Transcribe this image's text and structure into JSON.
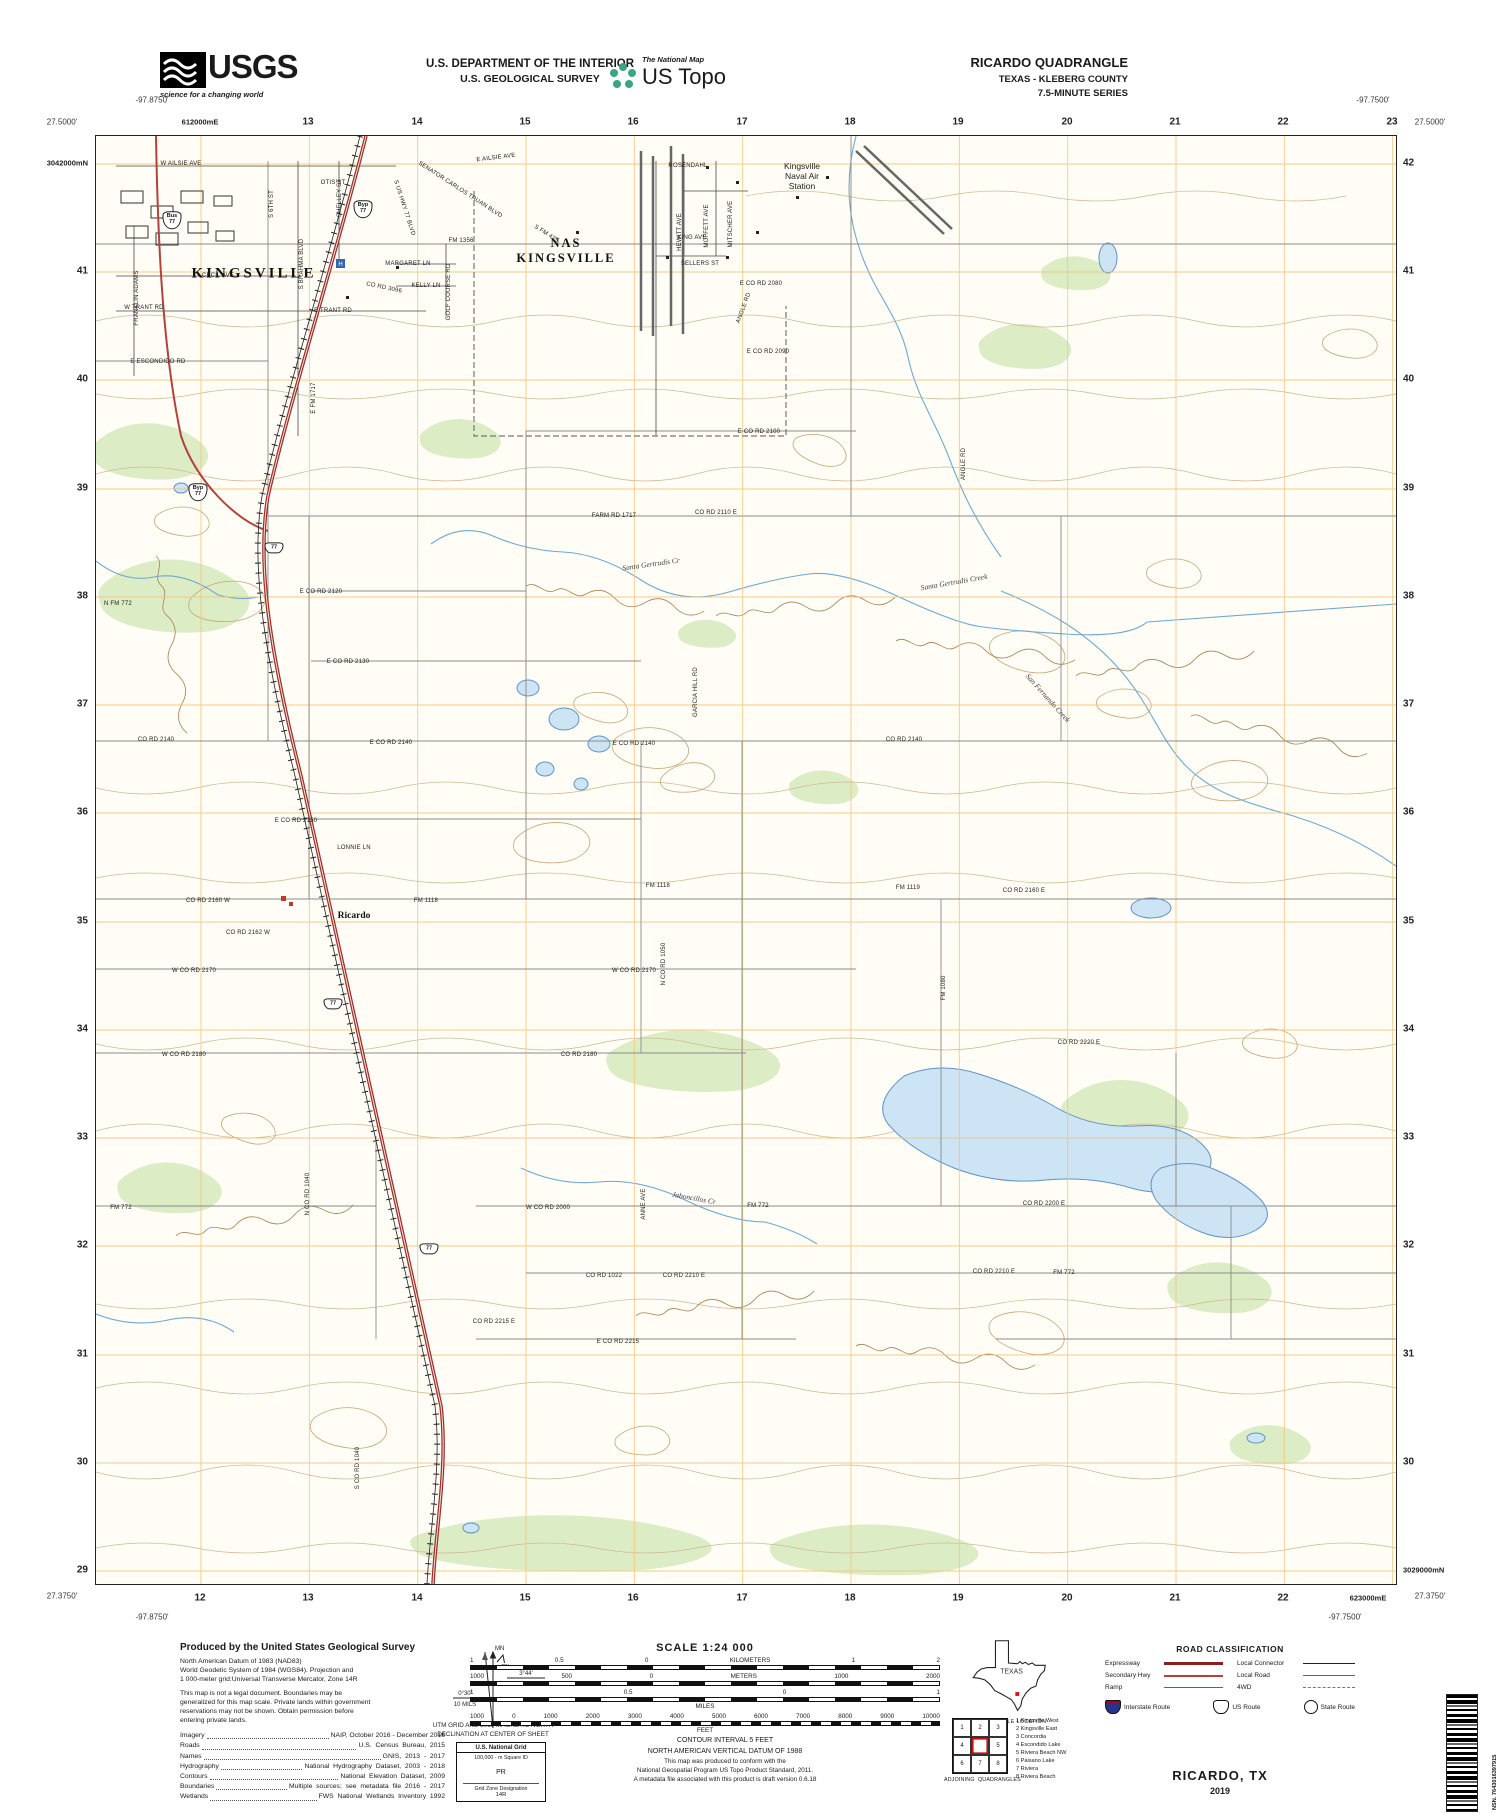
{
  "header": {
    "usgs_word": "USGS",
    "usgs_tagline": "science for a changing world",
    "dept_line1": "U.S. DEPARTMENT OF THE INTERIOR",
    "dept_line2": "U.S. GEOLOGICAL SURVEY",
    "ustopo_small": "The National Map",
    "ustopo_big": "US Topo",
    "quad_line1": "RICARDO QUADRANGLE",
    "quad_line2": "TEXAS - KLEBERG COUNTY",
    "quad_line3": "7.5-MINUTE SERIES"
  },
  "corners": [
    {
      "t": "-97.8750'",
      "x": 152,
      "y": 100
    },
    {
      "t": "27.5000'",
      "x": 62,
      "y": 122
    },
    {
      "t": "-97.7500'",
      "x": 1373,
      "y": 100
    },
    {
      "t": "27.5000'",
      "x": 1430,
      "y": 122
    },
    {
      "t": "27.3750'",
      "x": 62,
      "y": 1596
    },
    {
      "t": "-97.8750'",
      "x": 152,
      "y": 1617
    },
    {
      "t": "27.3750'",
      "x": 1430,
      "y": 1596
    },
    {
      "t": "-97.7500'",
      "x": 1345,
      "y": 1617
    }
  ],
  "grid_top": [
    {
      "t": "612000mE",
      "x": 200,
      "y": 122,
      "c": "utm"
    },
    {
      "t": "13",
      "x": 308,
      "y": 122
    },
    {
      "t": "14",
      "x": 417,
      "y": 122
    },
    {
      "t": "15",
      "x": 525,
      "y": 122
    },
    {
      "t": "16",
      "x": 633,
      "y": 122
    },
    {
      "t": "17",
      "x": 742,
      "y": 122
    },
    {
      "t": "18",
      "x": 850,
      "y": 122
    },
    {
      "t": "19",
      "x": 958,
      "y": 122
    },
    {
      "t": "20",
      "x": 1067,
      "y": 122
    },
    {
      "t": "21",
      "x": 1175,
      "y": 122
    },
    {
      "t": "22",
      "x": 1283,
      "y": 122
    },
    {
      "t": "23",
      "x": 1392,
      "y": 122
    }
  ],
  "grid_bottom": [
    {
      "t": "12",
      "x": 200,
      "y": 1598
    },
    {
      "t": "13",
      "x": 308,
      "y": 1598
    },
    {
      "t": "14",
      "x": 417,
      "y": 1598
    },
    {
      "t": "15",
      "x": 525,
      "y": 1598
    },
    {
      "t": "16",
      "x": 633,
      "y": 1598
    },
    {
      "t": "17",
      "x": 742,
      "y": 1598
    },
    {
      "t": "18",
      "x": 850,
      "y": 1598
    },
    {
      "t": "19",
      "x": 958,
      "y": 1598
    },
    {
      "t": "20",
      "x": 1067,
      "y": 1598
    },
    {
      "t": "21",
      "x": 1175,
      "y": 1598
    },
    {
      "t": "22",
      "x": 1283,
      "y": 1598
    },
    {
      "t": "623000mE",
      "x": 1368,
      "y": 1598,
      "c": "utm"
    }
  ],
  "grid_left": [
    {
      "t": "3042000mN",
      "x": 88,
      "y": 163,
      "c": "utm"
    },
    {
      "t": "41",
      "x": 88,
      "y": 271
    },
    {
      "t": "40",
      "x": 88,
      "y": 379
    },
    {
      "t": "39",
      "x": 88,
      "y": 488
    },
    {
      "t": "38",
      "x": 88,
      "y": 596
    },
    {
      "t": "37",
      "x": 88,
      "y": 704
    },
    {
      "t": "36",
      "x": 88,
      "y": 812
    },
    {
      "t": "35",
      "x": 88,
      "y": 921
    },
    {
      "t": "34",
      "x": 88,
      "y": 1029
    },
    {
      "t": "33",
      "x": 88,
      "y": 1137
    },
    {
      "t": "32",
      "x": 88,
      "y": 1245
    },
    {
      "t": "31",
      "x": 88,
      "y": 1354
    },
    {
      "t": "30",
      "x": 88,
      "y": 1462
    },
    {
      "t": "29",
      "x": 88,
      "y": 1570
    }
  ],
  "grid_right": [
    {
      "t": "42",
      "x": 1403,
      "y": 163
    },
    {
      "t": "41",
      "x": 1403,
      "y": 271
    },
    {
      "t": "40",
      "x": 1403,
      "y": 379
    },
    {
      "t": "39",
      "x": 1403,
      "y": 488
    },
    {
      "t": "38",
      "x": 1403,
      "y": 596
    },
    {
      "t": "37",
      "x": 1403,
      "y": 704
    },
    {
      "t": "36",
      "x": 1403,
      "y": 812
    },
    {
      "t": "35",
      "x": 1403,
      "y": 921
    },
    {
      "t": "34",
      "x": 1403,
      "y": 1029
    },
    {
      "t": "33",
      "x": 1403,
      "y": 1137
    },
    {
      "t": "32",
      "x": 1403,
      "y": 1245
    },
    {
      "t": "31",
      "x": 1403,
      "y": 1354
    },
    {
      "t": "30",
      "x": 1403,
      "y": 1462
    },
    {
      "t": "3029000mN",
      "x": 1403,
      "y": 1570,
      "c": "utm"
    }
  ],
  "towns": [
    {
      "t": "KINGSVILLE",
      "x": 158,
      "y": 138,
      "c": "town"
    },
    {
      "t": "NAS\nKINGSVILLE",
      "x": 470,
      "y": 115,
      "c": "town2"
    },
    {
      "t": "Kingsville\nNaval Air\nStation",
      "x": 706,
      "y": 40,
      "c": "nas3"
    },
    {
      "t": "Ricardo",
      "x": 258,
      "y": 780,
      "c": "town3"
    }
  ],
  "creeks": [
    {
      "t": "Santa Gertrudis Cr",
      "x": 555,
      "y": 428,
      "r": -8,
      "c": "creekl"
    },
    {
      "t": "Santa Gertrudis Creek",
      "x": 858,
      "y": 446,
      "r": -10,
      "c": "creekl"
    },
    {
      "t": "San Fernando Creek",
      "x": 952,
      "y": 562,
      "r": 48,
      "c": "creekl"
    },
    {
      "t": "Jaboncillos Cr",
      "x": 598,
      "y": 1062,
      "r": 10,
      "c": "creekl"
    }
  ],
  "roads": [
    {
      "t": "W AILSIE AVE",
      "x": 85,
      "y": 28
    },
    {
      "t": "E AILSIE AVE",
      "x": 400,
      "y": 22,
      "r": -7
    },
    {
      "t": "OTIS ST",
      "x": 237,
      "y": 47
    },
    {
      "t": "S 6TH ST",
      "x": 176,
      "y": 68,
      "r": -90
    },
    {
      "t": "SHELLEY ST",
      "x": 244,
      "y": 62,
      "r": -90
    },
    {
      "t": "S BRAHMA BLVD",
      "x": 206,
      "y": 128,
      "r": -90
    },
    {
      "t": "FRANKLIN ADAMS",
      "x": 41,
      "y": 162,
      "r": -90
    },
    {
      "t": "CECIL AVE",
      "x": 122,
      "y": 140
    },
    {
      "t": "W TRANT RD",
      "x": 48,
      "y": 172
    },
    {
      "t": "E TRANT RD",
      "x": 237,
      "y": 175
    },
    {
      "t": "E ESCONDIDO RD",
      "x": 62,
      "y": 226
    },
    {
      "t": "FM 1356",
      "x": 365,
      "y": 105
    },
    {
      "t": "SENATOR CARLOS TRUAN BLVD",
      "x": 364,
      "y": 54,
      "r": 33
    },
    {
      "t": "S FM 425",
      "x": 450,
      "y": 98,
      "r": 33
    },
    {
      "t": "S US HWY 77 BLVD",
      "x": 308,
      "y": 72,
      "r": 72
    },
    {
      "t": "MARGARET LN",
      "x": 312,
      "y": 128
    },
    {
      "t": "KELLY LN",
      "x": 330,
      "y": 150
    },
    {
      "t": "CO RD 3096",
      "x": 288,
      "y": 152,
      "r": 12
    },
    {
      "t": "GOLF COURSE RD",
      "x": 353,
      "y": 156,
      "r": -90
    },
    {
      "t": "ROSENDAHL",
      "x": 592,
      "y": 30
    },
    {
      "t": "KING AVE",
      "x": 596,
      "y": 102
    },
    {
      "t": "SELLERS ST",
      "x": 604,
      "y": 128
    },
    {
      "t": "HEWITT AVE",
      "x": 584,
      "y": 96,
      "r": -90
    },
    {
      "t": "MOFFETT AVE",
      "x": 611,
      "y": 90,
      "r": -90
    },
    {
      "t": "MITSCHER AVE",
      "x": 635,
      "y": 88,
      "r": -90
    },
    {
      "t": "ANGLE RD",
      "x": 648,
      "y": 172,
      "r": -70
    },
    {
      "t": "ANGLE RD",
      "x": 868,
      "y": 328,
      "r": -90
    },
    {
      "t": "E CO RD 2080",
      "x": 665,
      "y": 148
    },
    {
      "t": "E CO RD 2090",
      "x": 672,
      "y": 216
    },
    {
      "t": "E CO RD 2100",
      "x": 663,
      "y": 296
    },
    {
      "t": "E FM 1717",
      "x": 218,
      "y": 262,
      "r": -90
    },
    {
      "t": "FARM RD 1717",
      "x": 518,
      "y": 380
    },
    {
      "t": "CO RD 2110 E",
      "x": 620,
      "y": 377
    },
    {
      "t": "E CO RD 2120",
      "x": 225,
      "y": 456
    },
    {
      "t": "E CO RD 2130",
      "x": 252,
      "y": 526
    },
    {
      "t": "GARCIA HILL RD",
      "x": 600,
      "y": 556,
      "r": -90
    },
    {
      "t": "E CO RD 2140",
      "x": 295,
      "y": 607
    },
    {
      "t": "E CO RD 2140",
      "x": 538,
      "y": 608
    },
    {
      "t": "CO RD 2140",
      "x": 808,
      "y": 604
    },
    {
      "t": "CO RD 2140",
      "x": 60,
      "y": 604
    },
    {
      "t": "E CO RD 2150",
      "x": 200,
      "y": 685
    },
    {
      "t": "LONNIE LN",
      "x": 258,
      "y": 712
    },
    {
      "t": "FM 1118",
      "x": 330,
      "y": 765
    },
    {
      "t": "FM 1118",
      "x": 562,
      "y": 750
    },
    {
      "t": "FM 1119",
      "x": 812,
      "y": 752
    },
    {
      "t": "CO RD 2160 W",
      "x": 112,
      "y": 765
    },
    {
      "t": "CO RD 2162 W",
      "x": 152,
      "y": 797
    },
    {
      "t": "CO RD 2160 E",
      "x": 928,
      "y": 755
    },
    {
      "t": "W CO RD 2170",
      "x": 98,
      "y": 835
    },
    {
      "t": "W CO RD 2170",
      "x": 538,
      "y": 835
    },
    {
      "t": "N CO RD 1050",
      "x": 568,
      "y": 828,
      "r": -90
    },
    {
      "t": "FM 1080",
      "x": 848,
      "y": 852,
      "r": -90
    },
    {
      "t": "W CO RD 2180",
      "x": 88,
      "y": 919
    },
    {
      "t": "CO RD 2180",
      "x": 483,
      "y": 919
    },
    {
      "t": "CO RD 2220 E",
      "x": 983,
      "y": 907
    },
    {
      "t": "W CO RD 2000",
      "x": 452,
      "y": 1072
    },
    {
      "t": "ANNE AVE",
      "x": 548,
      "y": 1068,
      "r": -90
    },
    {
      "t": "FM 772",
      "x": 25,
      "y": 1072
    },
    {
      "t": "FM 772",
      "x": 662,
      "y": 1070
    },
    {
      "t": "FM 772",
      "x": 968,
      "y": 1137
    },
    {
      "t": "CO RD 2200 E",
      "x": 948,
      "y": 1068
    },
    {
      "t": "CO RD 1022",
      "x": 508,
      "y": 1140
    },
    {
      "t": "CO RD 2210 E",
      "x": 588,
      "y": 1140
    },
    {
      "t": "CO RD 2210 E",
      "x": 898,
      "y": 1136
    },
    {
      "t": "CO RD 2215 E",
      "x": 398,
      "y": 1186
    },
    {
      "t": "E CO RD 2215",
      "x": 522,
      "y": 1206
    },
    {
      "t": "S CO RD 1040",
      "x": 262,
      "y": 1332,
      "r": -90
    },
    {
      "t": "N CO RD 1040",
      "x": 212,
      "y": 1058,
      "r": -90
    },
    {
      "t": "N FM 772",
      "x": 22,
      "y": 468
    }
  ],
  "shields": [
    {
      "t": "Bus\n77",
      "x": 76,
      "y": 84
    },
    {
      "t": "Byp\n77",
      "x": 267,
      "y": 73
    },
    {
      "t": "Byp\n77",
      "x": 102,
      "y": 356
    },
    {
      "t": "77",
      "x": 178,
      "y": 412
    },
    {
      "t": "77",
      "x": 237,
      "y": 868
    },
    {
      "t": "77",
      "x": 333,
      "y": 1113
    }
  ],
  "credits": {
    "heading": "Produced by the United States Geological Survey",
    "p1": "North American Datum of 1983 (NAD83)\nWorld Geodetic System of 1984 (WGS84).  Projection and\n1 000-meter grid:Universal Transverse Mercator, Zone 14R",
    "p2": "This map is not a legal document. Boundaries may be\ngeneralized for this map scale. Private lands within government\nreservations may not be shown. Obtain permission before\nentering private lands.",
    "sources": [
      {
        "label": "Imagery",
        "val": "NAIP, October 2016 - December 2016"
      },
      {
        "label": "Roads",
        "val": "U.S.  Census  Bureau,  2015"
      },
      {
        "label": "Names",
        "val": "GNIS,  2013  -  2017"
      },
      {
        "label": "Hydrography",
        "val": "National  Hydrography  Dataset,  2003  -  2018"
      },
      {
        "label": "Contours",
        "val": "National  Elevation  Dataset,  2009"
      },
      {
        "label": "Boundaries",
        "val": "Multiple  sources;  see  metadata  file  2016  -  2017"
      },
      {
        "label": "Wetlands",
        "val": "FWS  National  Wetlands  Inventory  1992"
      }
    ]
  },
  "declination": {
    "mn": "MN",
    "gn": "GN",
    "gn_deg": "0°30'",
    "gn_mils": "10 MILS",
    "mn_deg": "3°44'",
    "mn_mils": "66 MILS",
    "caption": "UTM GRID AND 2019 MAGNETIC NORTH\nDECLINATION AT CENTER OF SHEET"
  },
  "usng": {
    "title": "U.S. National Grid",
    "sub": "100,000 - m Square ID",
    "square": "PR",
    "gz": "Grid Zone Designation",
    "zone": "14R"
  },
  "scale": {
    "title": "SCALE 1:24 000",
    "km_labels": [
      "1",
      "0.5",
      "0",
      "KILOMETERS",
      "1",
      "2"
    ],
    "m_labels": [
      "1000",
      "500",
      "0",
      "METERS",
      "1000",
      "2000"
    ],
    "mi_labels": [
      "1",
      "0.5",
      "0",
      "1"
    ],
    "mi_unit": "MILES",
    "ft_labels": [
      "1000",
      "0",
      "1000",
      "2000",
      "3000",
      "4000",
      "5000",
      "6000",
      "7000",
      "8000",
      "9000",
      "10000"
    ],
    "ft_unit": "FEET"
  },
  "contour_note": "CONTOUR INTERVAL 5 FEET\nNORTH AMERICAN VERTICAL DATUM OF 1988",
  "conform_note": "This map was produced to conform with the\nNational Geospatial Program US Topo Product Standard, 2011.\nA metadata file associated with this product is draft version 0.6.18",
  "texas": {
    "label": "TEXAS",
    "caption": "QUADRANGLE LOCATION"
  },
  "adjoining": {
    "cells": [
      "1",
      "2",
      "3",
      "4",
      {
        "t": "",
        "c": "qc-center"
      },
      "5",
      "6",
      "7",
      "8"
    ],
    "caption": "ADJOINING  QUADRANGLES",
    "names": [
      "1 Kingsville West",
      "2 Kingsville East",
      "3 Concordia",
      "4 Escondido Lake",
      "5 Riviera Beach NW",
      "6 Paisano Lake",
      "7 Riviera",
      "8 Riviera Beach"
    ]
  },
  "roadclass": {
    "title": "ROAD CLASSIFICATION",
    "left": [
      {
        "label": "Expressway",
        "c": "ln-exp"
      },
      {
        "label": "Secondary Hwy",
        "c": "ln-sec"
      },
      {
        "label": "Ramp",
        "c": "ln-ramp"
      }
    ],
    "right": [
      {
        "label": "Local Connector",
        "c": "ln-conn"
      },
      {
        "label": "Local Road",
        "c": "ln-loc"
      },
      {
        "label": "4WD",
        "c": "ln-4wd"
      }
    ],
    "interstate": "Interstate Route",
    "us_route": "US Route",
    "state_route": "State Route"
  },
  "title_block": {
    "name": "RICARDO,  TX",
    "year": "2019"
  },
  "barcode": {
    "nsn": "NSN. 7643016397915",
    "nga": "NGA REF NO. USGSX24K37749"
  }
}
